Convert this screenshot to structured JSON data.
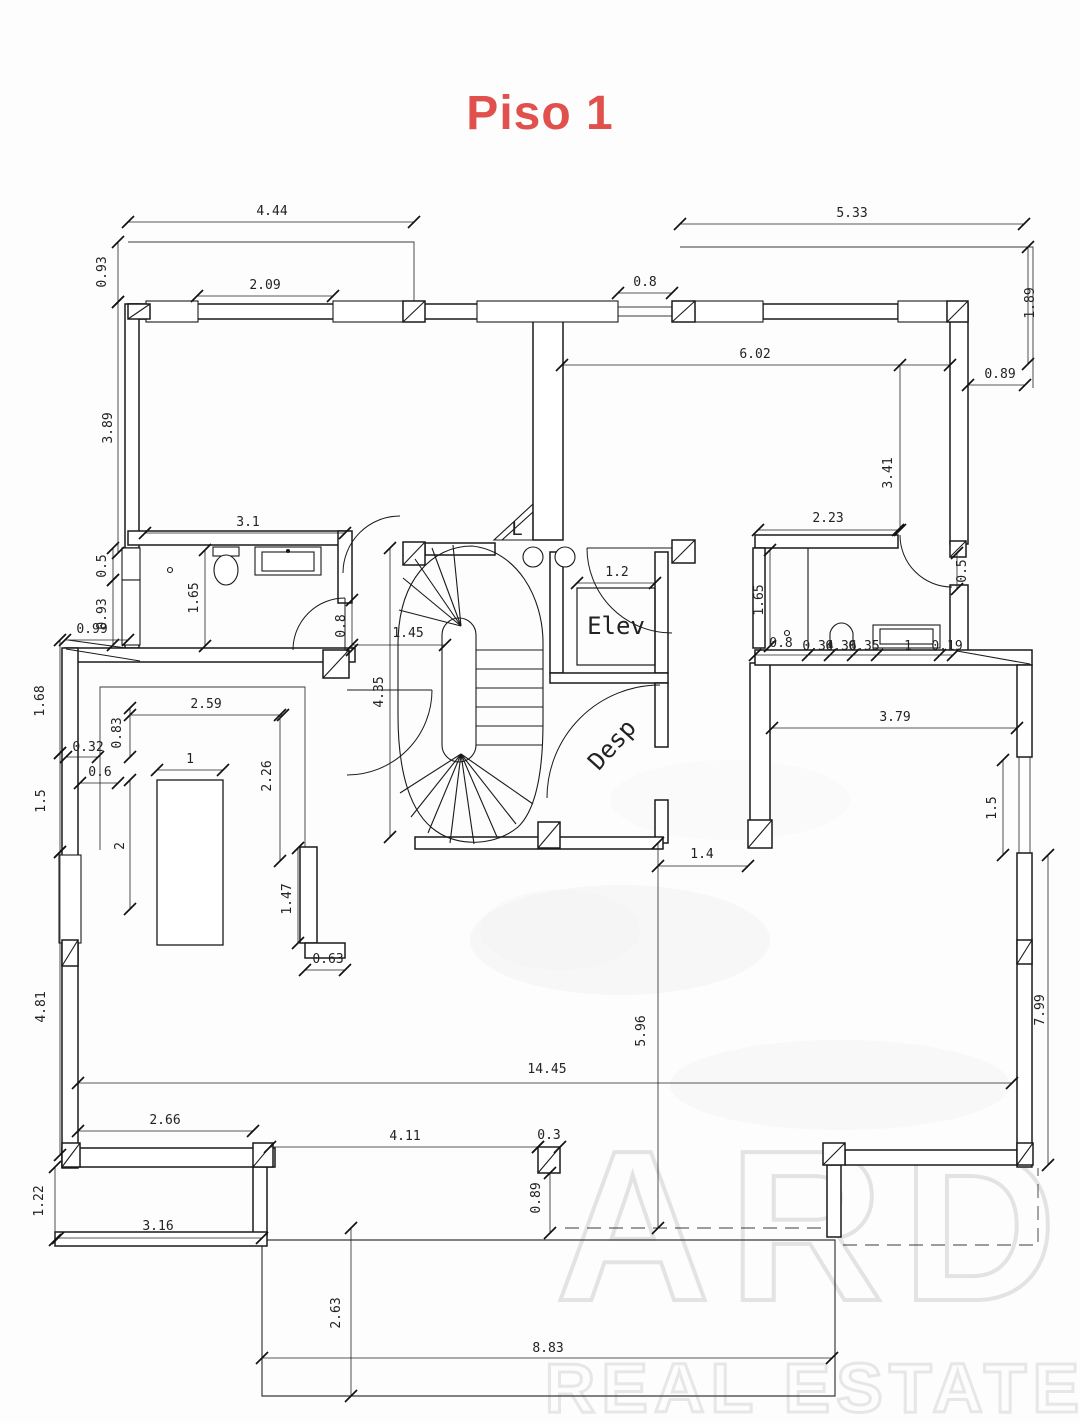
{
  "title": "Piso 1",
  "title_color": "#e0504c",
  "rooms": [
    {
      "id": "elevator",
      "label": "Elev",
      "x": 616,
      "y": 634,
      "rot": 0,
      "size": 24
    },
    {
      "id": "pantry",
      "label": "Desp",
      "x": 618,
      "y": 750,
      "rot": -48,
      "size": 24
    },
    {
      "id": "stair-landing",
      "label": "L",
      "x": 517,
      "y": 535,
      "rot": 0,
      "size": 19
    }
  ],
  "watermark": {
    "line1": "ARD",
    "line2": "REAL ESTATE"
  },
  "dimensions": [
    {
      "text": "4.44",
      "x": 272,
      "y": 215,
      "rot": 0
    },
    {
      "text": "0.93",
      "x": 106,
      "y": 272,
      "rot": -90
    },
    {
      "text": "2.09",
      "x": 265,
      "y": 289,
      "rot": 0
    },
    {
      "text": "5.33",
      "x": 852,
      "y": 217,
      "rot": 0
    },
    {
      "text": "0.8",
      "x": 645,
      "y": 286,
      "rot": 0
    },
    {
      "text": "1.89",
      "x": 1034,
      "y": 303,
      "rot": -90
    },
    {
      "text": "6.02",
      "x": 755,
      "y": 358,
      "rot": 0
    },
    {
      "text": "0.89",
      "x": 1000,
      "y": 378,
      "rot": 0
    },
    {
      "text": "3.41",
      "x": 892,
      "y": 473,
      "rot": -90
    },
    {
      "text": "3.89",
      "x": 112,
      "y": 428,
      "rot": -90
    },
    {
      "text": "3.1",
      "x": 248,
      "y": 526,
      "rot": 0
    },
    {
      "text": "0.5",
      "x": 106,
      "y": 566,
      "rot": -90
    },
    {
      "text": "1.65",
      "x": 198,
      "y": 598,
      "rot": -90
    },
    {
      "text": "0.93",
      "x": 106,
      "y": 614,
      "rot": -90
    },
    {
      "text": "0.99",
      "x": 92,
      "y": 633,
      "rot": 0
    },
    {
      "text": "0.8",
      "x": 345,
      "y": 626,
      "rot": -90
    },
    {
      "text": "1.45",
      "x": 408,
      "y": 637,
      "rot": 0
    },
    {
      "text": "4.35",
      "x": 383,
      "y": 692,
      "rot": -90
    },
    {
      "text": "1.2",
      "x": 617,
      "y": 576,
      "rot": 0
    },
    {
      "text": "2.23",
      "x": 828,
      "y": 522,
      "rot": 0
    },
    {
      "text": "1.65",
      "x": 763,
      "y": 600,
      "rot": -90
    },
    {
      "text": "0.5",
      "x": 966,
      "y": 571,
      "rot": -90
    },
    {
      "text": "0.8",
      "x": 781,
      "y": 647,
      "rot": 0
    },
    {
      "text": "0.34",
      "x": 818,
      "y": 650,
      "rot": 0
    },
    {
      "text": "0.36",
      "x": 841,
      "y": 650,
      "rot": 0
    },
    {
      "text": "0.35",
      "x": 864,
      "y": 650,
      "rot": 0
    },
    {
      "text": "1",
      "x": 908,
      "y": 650,
      "rot": 0
    },
    {
      "text": "0.19",
      "x": 947,
      "y": 650,
      "rot": 0
    },
    {
      "text": "3.79",
      "x": 895,
      "y": 721,
      "rot": 0
    },
    {
      "text": "1.5",
      "x": 996,
      "y": 808,
      "rot": -90
    },
    {
      "text": "7.99",
      "x": 1044,
      "y": 1010,
      "rot": -90
    },
    {
      "text": "1.68",
      "x": 44,
      "y": 701,
      "rot": -90
    },
    {
      "text": "2.59",
      "x": 206,
      "y": 708,
      "rot": 0
    },
    {
      "text": "0.83",
      "x": 121,
      "y": 733,
      "rot": -90
    },
    {
      "text": "0.32",
      "x": 88,
      "y": 751,
      "rot": 0
    },
    {
      "text": "0.6",
      "x": 100,
      "y": 776,
      "rot": 0
    },
    {
      "text": "1",
      "x": 190,
      "y": 763,
      "rot": 0
    },
    {
      "text": "2",
      "x": 124,
      "y": 846,
      "rot": -90
    },
    {
      "text": "2.26",
      "x": 271,
      "y": 776,
      "rot": -90
    },
    {
      "text": "1.5",
      "x": 45,
      "y": 801,
      "rot": -90
    },
    {
      "text": "1.47",
      "x": 291,
      "y": 899,
      "rot": -90
    },
    {
      "text": "0.63",
      "x": 328,
      "y": 963,
      "rot": 0
    },
    {
      "text": "4.81",
      "x": 45,
      "y": 1007,
      "rot": -90
    },
    {
      "text": "2.66",
      "x": 165,
      "y": 1124,
      "rot": 0
    },
    {
      "text": "1.22",
      "x": 43,
      "y": 1201,
      "rot": -90
    },
    {
      "text": "3.16",
      "x": 158,
      "y": 1230,
      "rot": 0
    },
    {
      "text": "14.45",
      "x": 547,
      "y": 1073,
      "rot": 0
    },
    {
      "text": "5.96",
      "x": 645,
      "y": 1031,
      "rot": -90
    },
    {
      "text": "1.4",
      "x": 702,
      "y": 858,
      "rot": 0
    },
    {
      "text": "4.11",
      "x": 405,
      "y": 1140,
      "rot": 0
    },
    {
      "text": "0.3",
      "x": 549,
      "y": 1139,
      "rot": 0
    },
    {
      "text": "0.89",
      "x": 540,
      "y": 1198,
      "rot": -90
    },
    {
      "text": "2.63",
      "x": 340,
      "y": 1313,
      "rot": -90
    },
    {
      "text": "8.83",
      "x": 548,
      "y": 1352,
      "rot": 0
    }
  ]
}
